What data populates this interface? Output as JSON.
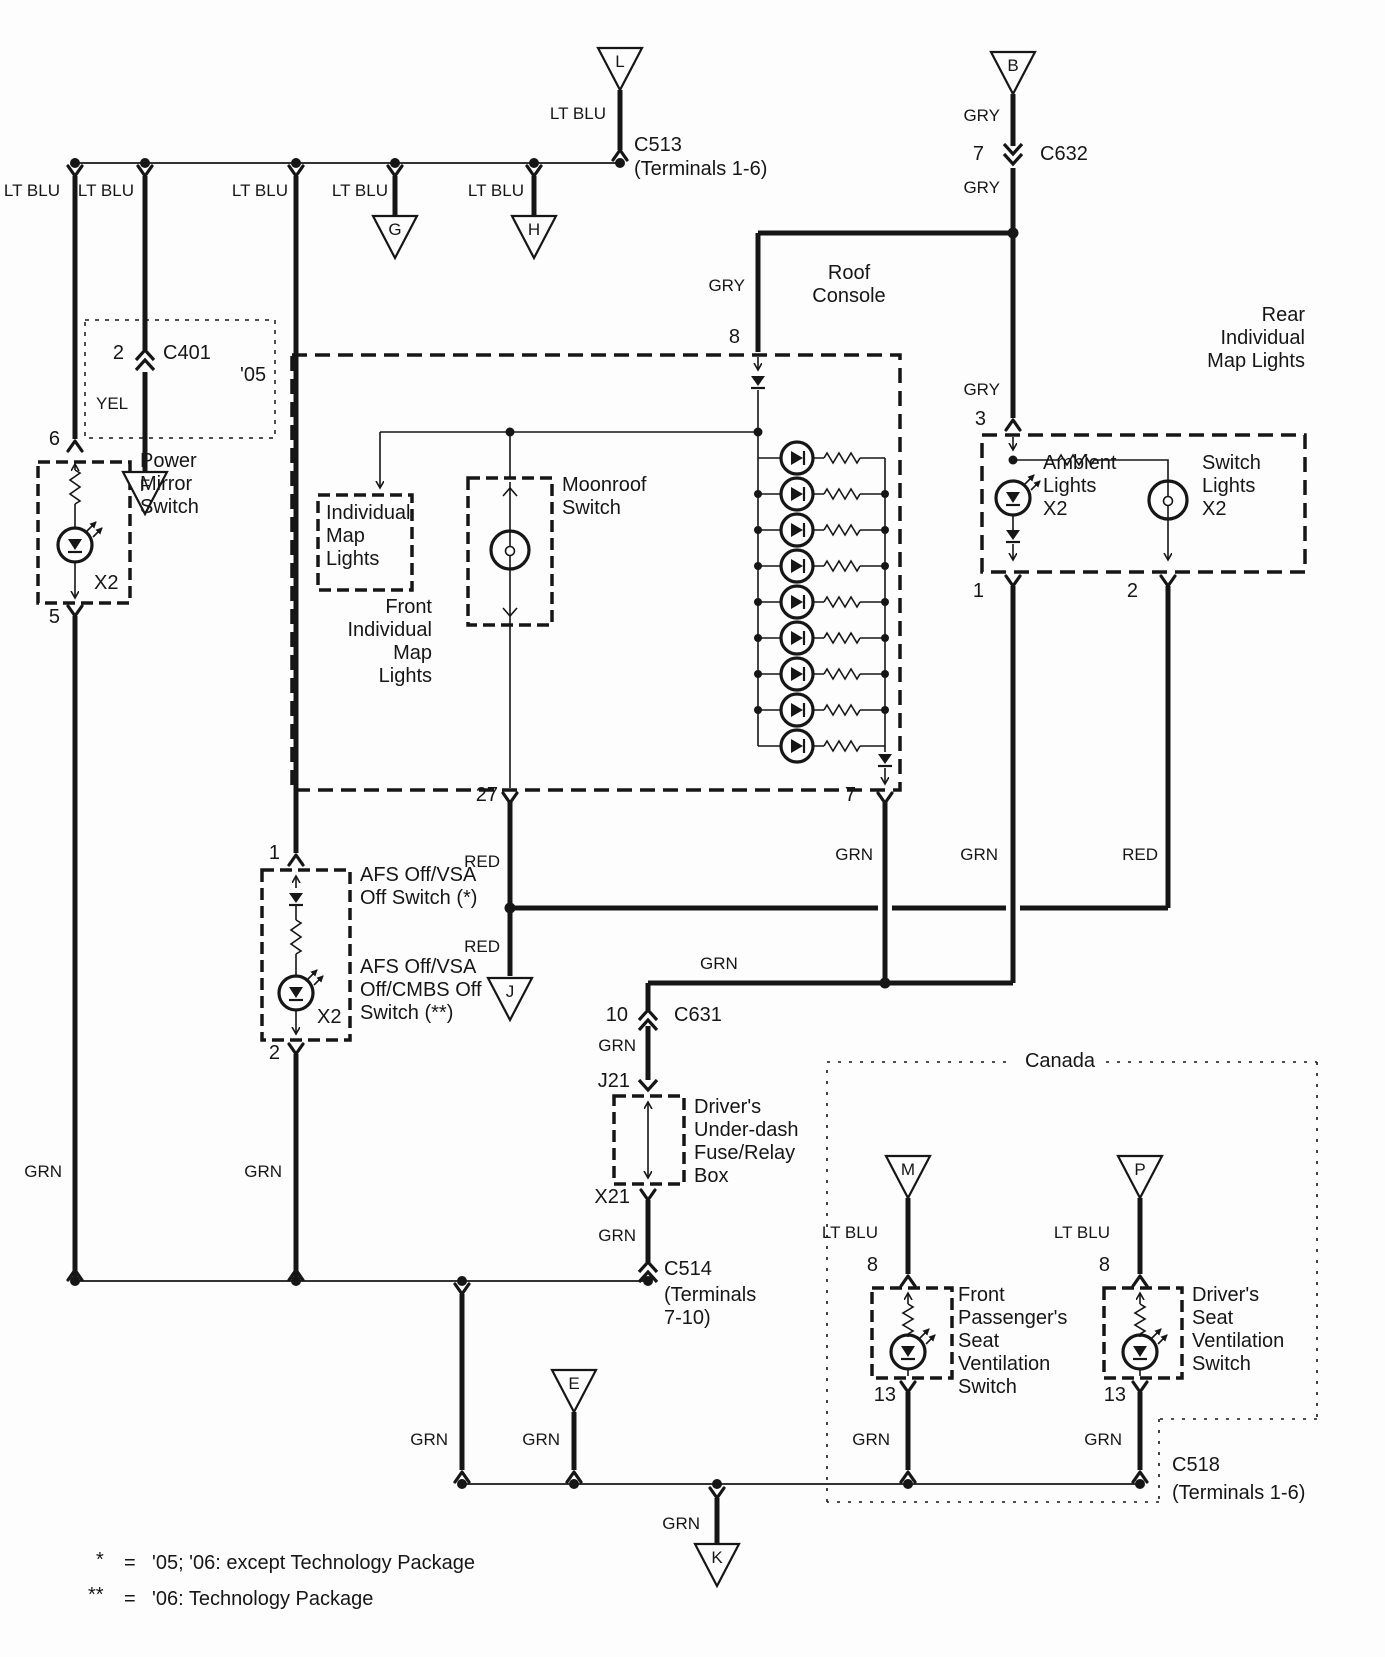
{
  "colors": {
    "ink": "#161616",
    "paper": "#fdfdfd"
  },
  "wire_labels": {
    "lt_blu": "LT BLU",
    "gry": "GRY",
    "grn": "GRN",
    "red": "RED",
    "yel": "YEL"
  },
  "pins": {
    "p1": "1",
    "p2": "2",
    "p3": "3",
    "p5": "5",
    "p6": "6",
    "p7": "7",
    "p8": "8",
    "p10": "10",
    "p13": "13",
    "p27": "27"
  },
  "connectors": {
    "c513": {
      "name": "C513",
      "terminals": "(Terminals 1-6)"
    },
    "c632": {
      "name": "C632"
    },
    "c401": {
      "name": "C401"
    },
    "c631": {
      "name": "C631"
    },
    "c514": {
      "name": "C514",
      "terminals": "(Terminals\n7-10)"
    },
    "c518": {
      "name": "C518",
      "terminals": "(Terminals 1-6)"
    },
    "j21": {
      "name": "J21"
    },
    "x21": {
      "name": "X21"
    }
  },
  "ref_arrows": {
    "l": "L",
    "b": "B",
    "g": "G",
    "h": "H",
    "f": "F",
    "j": "J",
    "e": "E",
    "k": "K",
    "m": "M",
    "p": "P"
  },
  "components": {
    "roof_console": "Roof\nConsole",
    "individual_map_lights": "Individual\nMap\nLights",
    "front_individual_map_lights": "Front\nIndividual\nMap\nLights",
    "moonroof_switch": "Moonroof\nSwitch",
    "rear_individual_map_lights": "Rear\nIndividual\nMap Lights",
    "ambient_lights": "Ambient\nLights\nX2",
    "switch_lights": "Switch\nLights\nX2",
    "power_mirror_switch": "Power\nMirror\nSwitch",
    "power_mirror_x2": "X2",
    "afs_switch_05": "AFS Off/VSA\nOff Switch (*)",
    "afs_switch_06": "AFS Off/VSA\nOff/CMBS Off\nSwitch (**)",
    "afs_x2": "X2",
    "fuse_relay_box": "Driver's\nUnder-dash\nFuse/Relay\nBox",
    "canada_region": "Canada",
    "front_passenger_vent": "Front\nPassenger's\nSeat\nVentilation\nSwitch",
    "driver_vent": "Driver's\nSeat\nVentilation\nSwitch",
    "year_05": "'05"
  },
  "footnotes": {
    "n1": {
      "sym": "*",
      "eq": "=",
      "text": "'05; '06: except Technology Package"
    },
    "n2": {
      "sym": "**",
      "eq": "=",
      "text": "'06: Technology Package"
    }
  }
}
